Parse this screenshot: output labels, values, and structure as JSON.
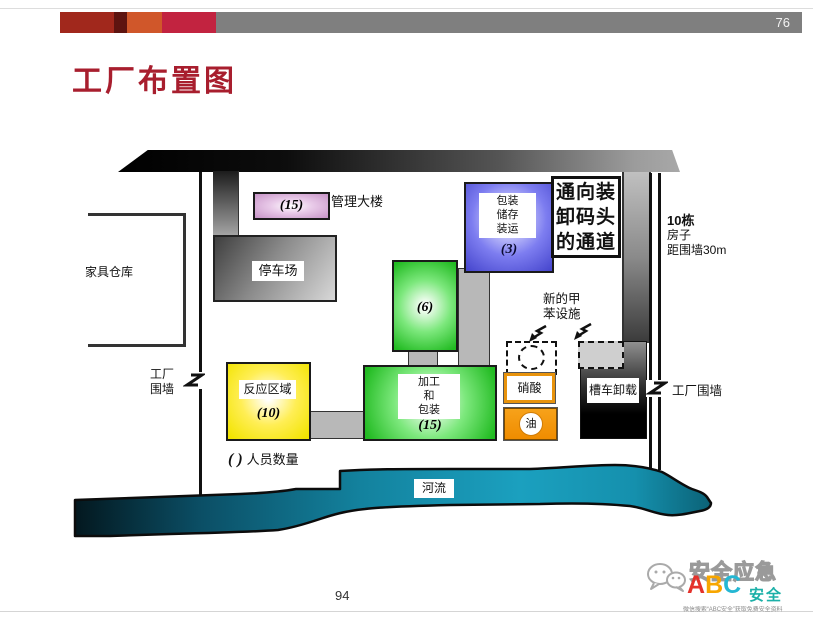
{
  "page": {
    "slide_number_top": "76",
    "slide_number_bottom": "94",
    "title": "工厂布置图"
  },
  "colors": {
    "title_red": "#a81e2e",
    "header_bar_gray": "#7f7f7f",
    "accent_blocks": [
      "#a1281c",
      "#5e1410",
      "#d0572a",
      "#c22340"
    ],
    "admin_purple": "#c793c7",
    "storage_blue": "#4444cc",
    "process_green": "#22bb22",
    "reaction_yellow": "#f2e400",
    "orange": "#ef8c00",
    "river_teal": "#1590ad"
  },
  "diagram": {
    "furniture_warehouse_label": "家具仓库",
    "admin_building": {
      "label": "管理大楼",
      "count": "(15)"
    },
    "parking_label": "停车场",
    "packaging": {
      "line1": "包装",
      "line2": "储存",
      "line3": "装运",
      "count": "(3)"
    },
    "corridor": {
      "line1": "通向装",
      "line2": "卸码头",
      "line3": "的通道"
    },
    "houses": {
      "line1": "10栋",
      "line2": "房子",
      "line3": "距围墙30m"
    },
    "unit6_count": "(6)",
    "toluene": {
      "line1": "新的甲",
      "line2": "苯设施"
    },
    "reaction": {
      "label": "反应区域",
      "count": "(10)"
    },
    "processing": {
      "line1": "加工",
      "line2": "和",
      "line3": "包装",
      "count": "(15)"
    },
    "nitric_acid_label": "硝酸",
    "oil_label": "油",
    "tank_unloading_label": "槽车卸载",
    "factory_wall_left": {
      "line1": "工厂",
      "line2": "围墙"
    },
    "factory_wall_right": "工厂围墙",
    "legend": {
      "symbol": "( )",
      "text": "人员数量"
    },
    "river_label": "河流"
  },
  "logo": {
    "brand_outline": "安全应急",
    "abc": {
      "a": "A",
      "b": "B",
      "c": "C"
    },
    "brand_sub": "安全",
    "slogan": "微信搜索“ABC安全”获取免费安全资料"
  }
}
